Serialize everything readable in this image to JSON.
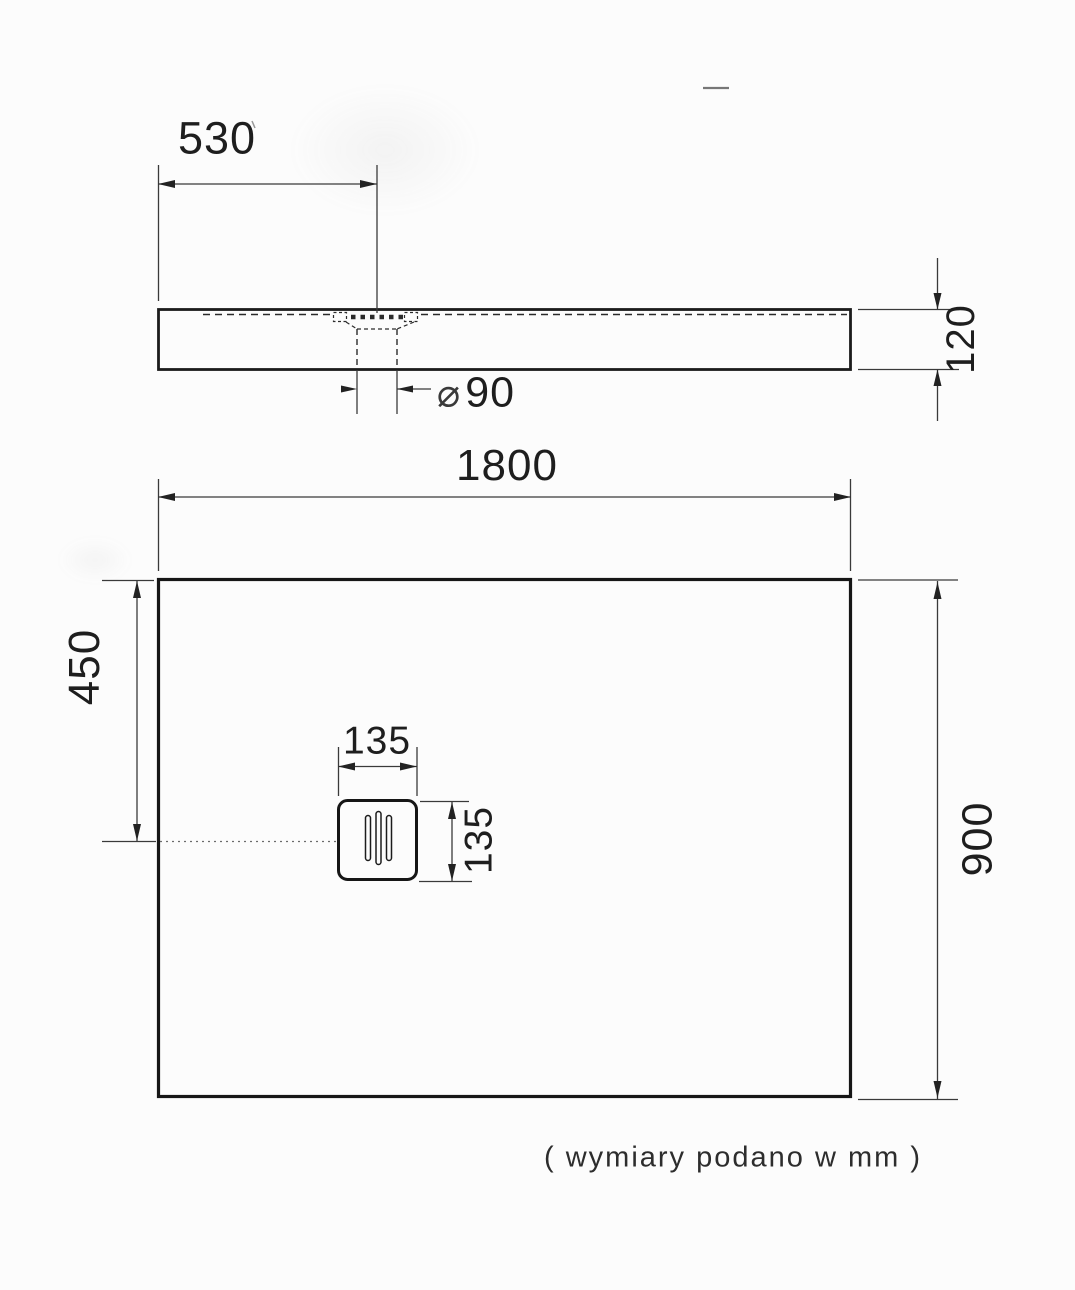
{
  "drawing": {
    "caption": "( wymiary podano w mm )",
    "side_view": {
      "drain_offset_label": "530",
      "height_label": "120",
      "drain_diameter_symbol": "⌀",
      "drain_diameter_value": "90"
    },
    "plan_view": {
      "width_label": "1800",
      "depth_label": "900",
      "drain_center_offset_label": "450",
      "drain_width_label": "135",
      "drain_depth_label": "135"
    }
  }
}
